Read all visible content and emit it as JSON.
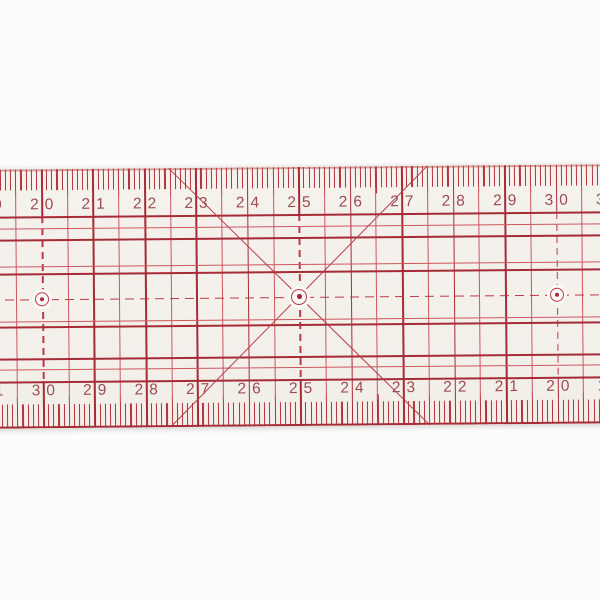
{
  "ruler": {
    "top_scale_values": [
      "19",
      "20",
      "21",
      "22",
      "23",
      "24",
      "25",
      "26",
      "27",
      "28",
      "29",
      "30",
      "31"
    ],
    "bottom_scale_values": [
      "31",
      "30",
      "29",
      "28",
      "27",
      "26",
      "25",
      "24",
      "23",
      "22",
      "21",
      "20",
      "19"
    ],
    "hole_count": 3,
    "hole_positions_on_top_scale": [
      "20",
      "25",
      "30"
    ],
    "center_line_style": "dashed",
    "diagonal_cross": "X centered on middle hole",
    "colors": {
      "grid_dark": "#a62b36",
      "grid_red": "#bb3a46",
      "grid_light": "#cd5660",
      "tick_red": "#b23440",
      "digit": "#9d4b52",
      "body": "#f5f2ed",
      "hole_fill": "#fbfaf8",
      "background": "#fcfcfc"
    }
  }
}
